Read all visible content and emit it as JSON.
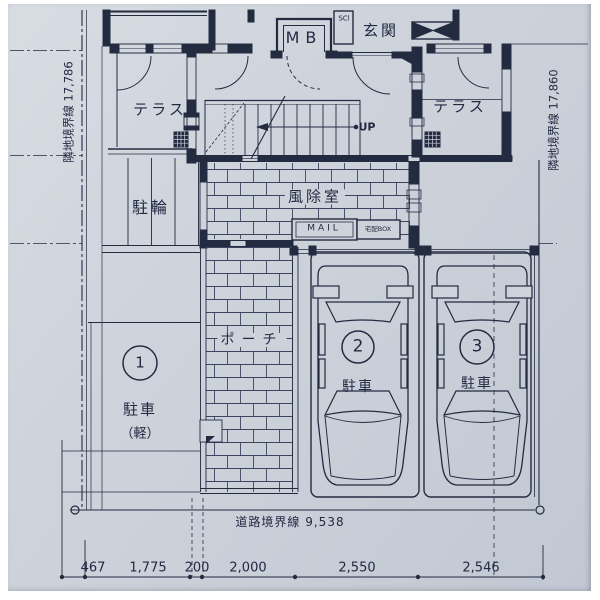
{
  "colors": {
    "paper": "#ccd1d9",
    "line": "#232b40"
  },
  "site": {
    "boundary_left": "隣地境界線 17,786",
    "boundary_right": "隣地境界線 17,860",
    "road_boundary": "道路境界線 9,538"
  },
  "plan": {
    "terrace_left": "テラス",
    "terrace_right": "テラス",
    "meter_box": "MB",
    "shoe_closet": "SCl",
    "entrance": "玄関",
    "stairs_up": "UP",
    "windbreak_room": "風除室",
    "mailbox": "MAIL",
    "delivery_box": "宅配BOX",
    "bicycle_parking": "駐輪",
    "porch": "ポーチ"
  },
  "parking": {
    "space1": {
      "number": "1",
      "label": "駐車",
      "sub": "（軽）"
    },
    "space2": {
      "number": "2",
      "label": "駐車"
    },
    "space3": {
      "number": "3",
      "label": "駐車"
    }
  },
  "dimensions": {
    "bottom": [
      "467",
      "1,775",
      "200",
      "2,000",
      "2,550",
      "2,546"
    ]
  }
}
